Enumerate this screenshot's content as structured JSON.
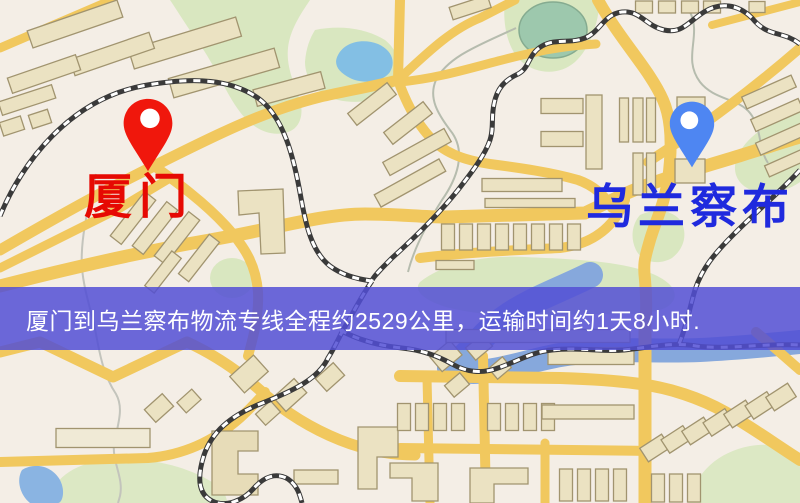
{
  "banner": {
    "text": "厦门到乌兰察布物流专线全程约2529公里，运输时间约1天8小时.",
    "background_color": "#524fd5",
    "text_color": "#ffffff",
    "distance_km": "2529",
    "duration": "1天8小时"
  },
  "origin": {
    "label": "厦门",
    "label_color": "#e60903",
    "pin_color": "#f0170c",
    "pin_icon": "map-pin-icon"
  },
  "destination": {
    "label": "乌兰察布",
    "label_color": "#1f2ade",
    "pin_color": "#4e86f2",
    "pin_icon": "map-pin-icon"
  },
  "map": {
    "kind": "street-map",
    "background_color": "#f4eee6",
    "road_color": "#f1c85e",
    "park_color": "#d9e7c0",
    "water_color": "#86a8dc",
    "railway_style": "black-white-dashed"
  }
}
